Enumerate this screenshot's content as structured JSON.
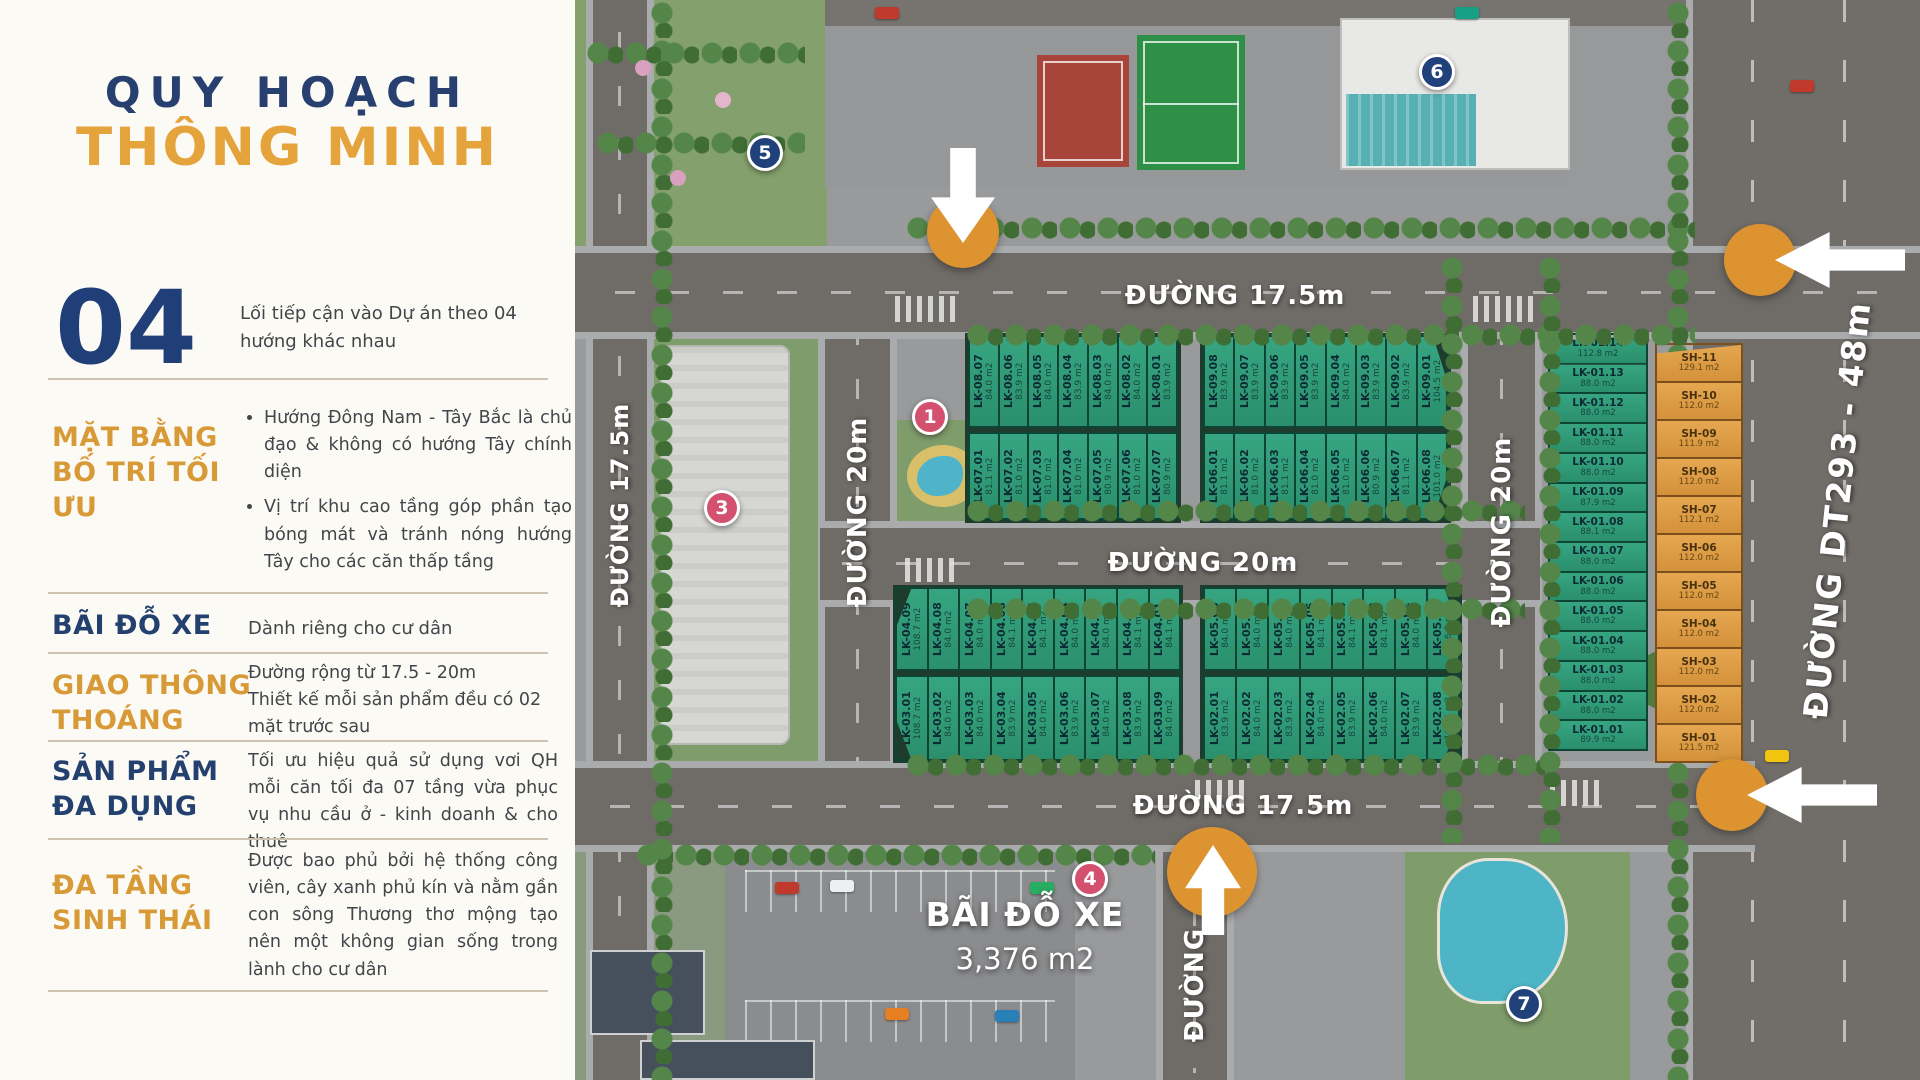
{
  "left_panel": {
    "title_line1": "QUY HOẠCH",
    "title_line2": "THÔNG MINH",
    "number_block": {
      "number": "04",
      "text": "Lối tiếp cận vào Dự án theo 04 hướng khác nhau"
    },
    "sections": {
      "layout": {
        "heading": "MẶT BẰNG BỐ TRÍ TỐI ƯU",
        "bullet1": "Hướng Đông Nam - Tây Bắc là chủ đạo & không có hướng Tây chính diện",
        "bullet2": "Vị trí khu cao tầng góp phần tạo bóng mát và tránh nóng hướng Tây cho các căn thấp tầng"
      },
      "parking": {
        "heading": "BÃI ĐỖ XE",
        "body": "Dành riêng cho cư dân"
      },
      "traffic": {
        "heading": "GIAO THÔNG THOÁNG",
        "body": "Đường rộng từ 17.5 - 20m\nThiết kế mỗi sản phẩm đều có 02 mặt trước sau"
      },
      "product": {
        "heading": "SẢN PHẨM ĐA DỤNG",
        "body": "Tối ưu hiệu quả sử dụng vơi QH mỗi căn tối đa 07 tầng vừa phục vụ nhu cầu ở - kinh doanh & cho thuê"
      },
      "eco": {
        "heading": "ĐA TẦNG SINH THÁI",
        "body": "Được bao phủ bởi hệ thống công viên, cây xanh phủ kín và nằm gần con sông Thương thơ mộng tạo nên một không gian sống trong lành cho cư dân"
      }
    }
  },
  "map": {
    "road_labels": {
      "top": "ĐƯỜNG 17.5m",
      "middle": "ĐƯỜNG 20m",
      "bottom": "ĐƯỜNG 17.5m",
      "left_vertical": "ĐƯỜNG 17.5m",
      "v20_left": "ĐƯỜNG 20m",
      "v20_right": "ĐƯỜNG 20m",
      "bottom_vertical": "ĐƯỜNG",
      "dt293": "ĐƯỜNG DT293 - 48m"
    },
    "parking_label": {
      "line1": "BÃI ĐỖ XE",
      "line2": "3,376 m2"
    },
    "badges": {
      "b1": "1",
      "b3": "3",
      "b4": "4",
      "b5": "5",
      "b6": "6",
      "b7": "7"
    },
    "blocks": {
      "row1_left": [
        {
          "code": "LK-08.07",
          "area": "84.0 m2"
        },
        {
          "code": "LK-08.06",
          "area": "83.9 m2"
        },
        {
          "code": "LK-08.05",
          "area": "84.0 m2"
        },
        {
          "code": "LK-08.04",
          "area": "83.9 m2"
        },
        {
          "code": "LK-08.03",
          "area": "84.0 m2"
        },
        {
          "code": "LK-08.02",
          "area": "84.0 m2"
        },
        {
          "code": "LK-08.01",
          "area": "83.9 m2"
        }
      ],
      "row1_right": [
        {
          "code": "LK-09.08",
          "area": "83.9 m2"
        },
        {
          "code": "LK-09.07",
          "area": "83.9 m2"
        },
        {
          "code": "LK-09.06",
          "area": "83.9 m2"
        },
        {
          "code": "LK-09.05",
          "area": "83.9 m2"
        },
        {
          "code": "LK-09.04",
          "area": "84.0 m2"
        },
        {
          "code": "LK-09.03",
          "area": "83.9 m2"
        },
        {
          "code": "LK-09.02",
          "area": "83.9 m2"
        },
        {
          "code": "LK-09.01",
          "area": "104.5 m2"
        }
      ],
      "row2_left": [
        {
          "code": "LK-07.01",
          "area": "81.1 m2"
        },
        {
          "code": "LK-07.02",
          "area": "81.0 m2"
        },
        {
          "code": "LK-07.03",
          "area": "81.0 m2"
        },
        {
          "code": "LK-07.04",
          "area": "81.0 m2"
        },
        {
          "code": "LK-07.05",
          "area": "80.9 m2"
        },
        {
          "code": "LK-07.06",
          "area": "81.0 m2"
        },
        {
          "code": "LK-07.07",
          "area": "80.9 m2"
        }
      ],
      "row2_right": [
        {
          "code": "LK-06.01",
          "area": "81.1 m2"
        },
        {
          "code": "LK-06.02",
          "area": "81.0 m2"
        },
        {
          "code": "LK-06.03",
          "area": "81.1 m2"
        },
        {
          "code": "LK-06.04",
          "area": "81.0 m2"
        },
        {
          "code": "LK-06.05",
          "area": "81.0 m2"
        },
        {
          "code": "LK-06.06",
          "area": "80.9 m2"
        },
        {
          "code": "LK-06.07",
          "area": "81.1 m2"
        },
        {
          "code": "LK-06.08",
          "area": "101.0 m2"
        }
      ],
      "row3_left": [
        {
          "code": "LK-04.09",
          "area": "108.7 m2"
        },
        {
          "code": "LK-04.08",
          "area": "84.0 m2"
        },
        {
          "code": "LK-04.07",
          "area": "84.0 m2"
        },
        {
          "code": "LK-04.06",
          "area": "84.1 m2"
        },
        {
          "code": "LK-04.05",
          "area": "84.1 m2"
        },
        {
          "code": "LK-04.04",
          "area": "84.0 m2"
        },
        {
          "code": "LK-04.03",
          "area": "84.0 m2"
        },
        {
          "code": "LK-04.02",
          "area": "84.1 m2"
        },
        {
          "code": "LK-04.01",
          "area": "84.1 m2"
        }
      ],
      "row3_right": [
        {
          "code": "LK-05.08",
          "area": "84.0 m2"
        },
        {
          "code": "LK-05.07",
          "area": "84.0 m2"
        },
        {
          "code": "LK-05.06",
          "area": "84.0 m2"
        },
        {
          "code": "LK-05.05",
          "area": "84.1 m2"
        },
        {
          "code": "LK-05.04",
          "area": "84.1 m2"
        },
        {
          "code": "LK-05.03",
          "area": "84.1 m2"
        },
        {
          "code": "LK-05.02",
          "area": "84.0 m2"
        },
        {
          "code": "LK-05.01",
          "area": "106.0 m2"
        }
      ],
      "row4_left": [
        {
          "code": "LK-03.01",
          "area": "108.7 m2"
        },
        {
          "code": "LK-03.02",
          "area": "84.0 m2"
        },
        {
          "code": "LK-03.03",
          "area": "84.0 m2"
        },
        {
          "code": "LK-03.04",
          "area": "83.9 m2"
        },
        {
          "code": "LK-03.05",
          "area": "84.0 m2"
        },
        {
          "code": "LK-03.06",
          "area": "83.9 m2"
        },
        {
          "code": "LK-03.07",
          "area": "84.0 m2"
        },
        {
          "code": "LK-03.08",
          "area": "83.9 m2"
        },
        {
          "code": "LK-03.09",
          "area": "84.0 m2"
        }
      ],
      "row4_right": [
        {
          "code": "LK-02.01",
          "area": "83.9 m2"
        },
        {
          "code": "LK-02.02",
          "area": "84.0 m2"
        },
        {
          "code": "LK-02.03",
          "area": "83.9 m2"
        },
        {
          "code": "LK-02.04",
          "area": "84.0 m2"
        },
        {
          "code": "LK-02.05",
          "area": "83.9 m2"
        },
        {
          "code": "LK-02.06",
          "area": "84.0 m2"
        },
        {
          "code": "LK-02.07",
          "area": "83.9 m2"
        },
        {
          "code": "LK-02.08",
          "area": "106.4 m2"
        }
      ],
      "col_lk01": [
        {
          "code": "LK-01.14",
          "area": "112.8 m2"
        },
        {
          "code": "LK-01.13",
          "area": "88.0 m2"
        },
        {
          "code": "LK-01.12",
          "area": "88.0 m2"
        },
        {
          "code": "LK-01.11",
          "area": "88.0 m2"
        },
        {
          "code": "LK-01.10",
          "area": "88.0 m2"
        },
        {
          "code": "LK-01.09",
          "area": "87.9 m2"
        },
        {
          "code": "LK-01.08",
          "area": "88.1 m2"
        },
        {
          "code": "LK-01.07",
          "area": "88.0 m2"
        },
        {
          "code": "LK-01.06",
          "area": "88.0 m2"
        },
        {
          "code": "LK-01.05",
          "area": "88.0 m2"
        },
        {
          "code": "LK-01.04",
          "area": "88.0 m2"
        },
        {
          "code": "LK-01.03",
          "area": "88.0 m2"
        },
        {
          "code": "LK-01.02",
          "area": "88.0 m2"
        },
        {
          "code": "LK-01.01",
          "area": "89.9 m2"
        }
      ],
      "col_sh": [
        {
          "code": "SH-11",
          "area": "129.1 m2"
        },
        {
          "code": "SH-10",
          "area": "112.0 m2"
        },
        {
          "code": "SH-09",
          "area": "111.9 m2"
        },
        {
          "code": "SH-08",
          "area": "112.0 m2"
        },
        {
          "code": "SH-07",
          "area": "112.1 m2"
        },
        {
          "code": "SH-06",
          "area": "112.0 m2"
        },
        {
          "code": "SH-05",
          "area": "112.0 m2"
        },
        {
          "code": "SH-04",
          "area": "112.0 m2"
        },
        {
          "code": "SH-03",
          "area": "112.0 m2"
        },
        {
          "code": "SH-02",
          "area": "112.0 m2"
        },
        {
          "code": "SH-01",
          "area": "121.5 m2"
        }
      ]
    },
    "colors": {
      "lot_green": "#2e9b77",
      "lot_orange": "#dd9b44",
      "badge_navy": "#20417a",
      "badge_pink": "#d4506f",
      "arrow_orange": "#dc9330",
      "accent_gold": "#e5a33b",
      "accent_navy": "#28406f"
    }
  }
}
